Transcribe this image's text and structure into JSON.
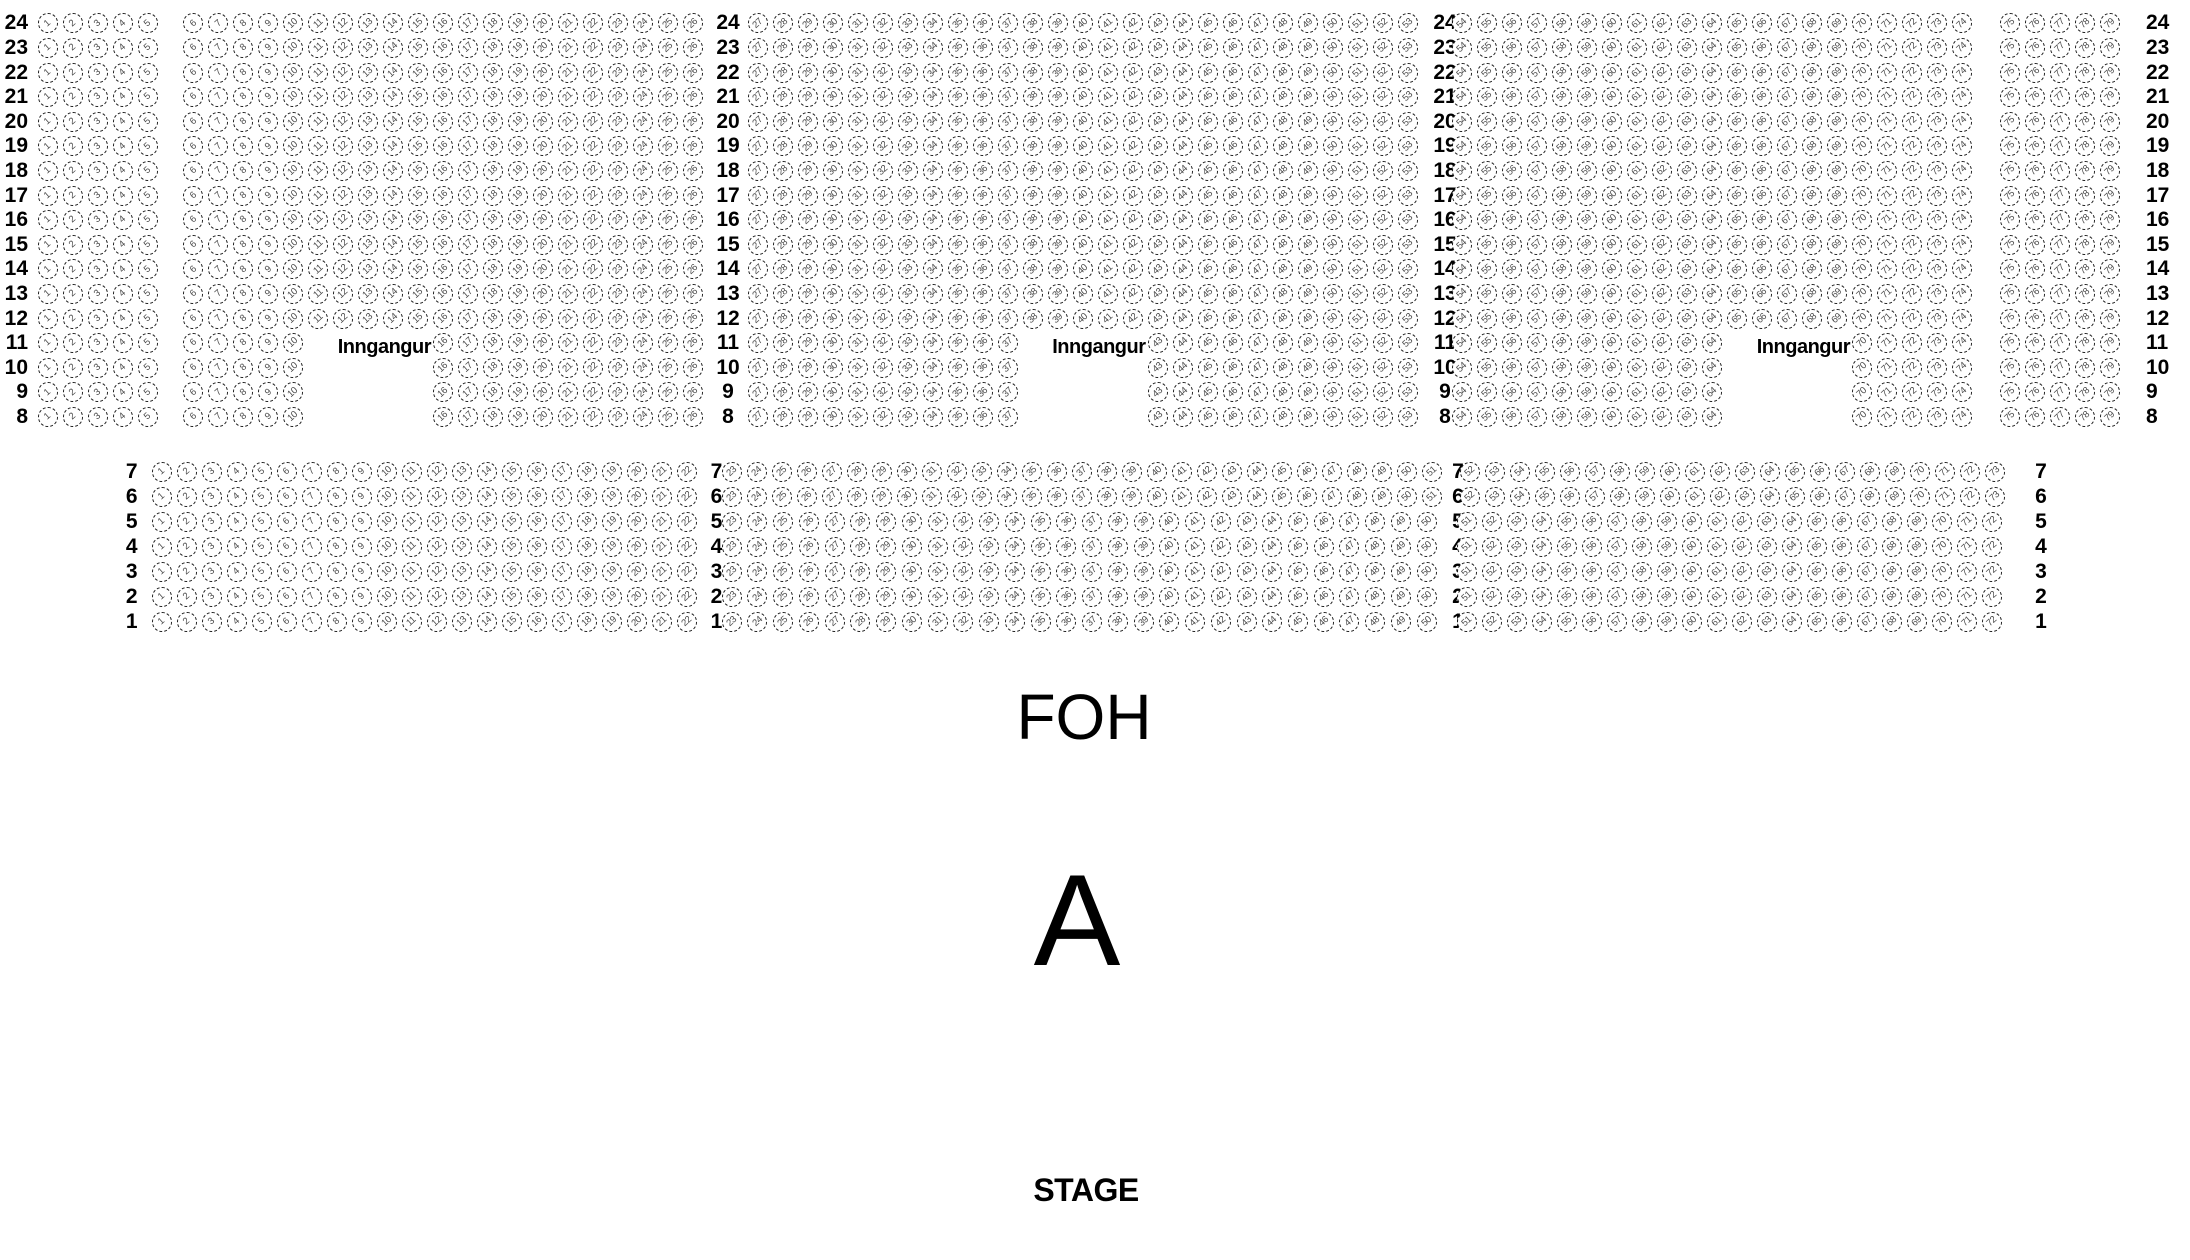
{
  "chart": {
    "section_name": "A",
    "foh_label": "FOH",
    "stage_label": "STAGE",
    "entrance_label": "Inngangur"
  },
  "seat_map": {
    "upper_block": {
      "full_rows": [
        24,
        23,
        22,
        21,
        20,
        19,
        18,
        17,
        16,
        15,
        14,
        13,
        12
      ],
      "split_rows": [
        11,
        10,
        9,
        8
      ],
      "full_row_seat_groups": [
        [
          1,
          5
        ],
        [
          6,
          26
        ],
        [
          27,
          53
        ],
        [
          54,
          74
        ],
        [
          75,
          79
        ]
      ],
      "split_row_seat_groups": [
        [
          1,
          5
        ],
        [
          6,
          10
        ],
        [
          16,
          26
        ],
        [
          27,
          37
        ],
        [
          43,
          53
        ],
        [
          54,
          64
        ],
        [
          70,
          74
        ],
        [
          75,
          79
        ]
      ],
      "entrance_row": 11,
      "entrance_before_seats": [
        16,
        43,
        70
      ]
    },
    "lower_block": {
      "wide_rows": [
        7,
        6
      ],
      "narrow_rows": [
        5,
        4,
        3,
        2,
        1
      ],
      "wide_row_seat_groups": [
        [
          1,
          22
        ],
        [
          23,
          51
        ],
        [
          52,
          73
        ]
      ],
      "narrow_row_seat_groups": [
        [
          1,
          22
        ],
        [
          23,
          50
        ],
        [
          51,
          72
        ]
      ]
    }
  },
  "colors": {
    "background": "#ffffff",
    "seat_border": "#1a1a1a",
    "seat_number": "#4a4a4a",
    "text": "#000000"
  }
}
